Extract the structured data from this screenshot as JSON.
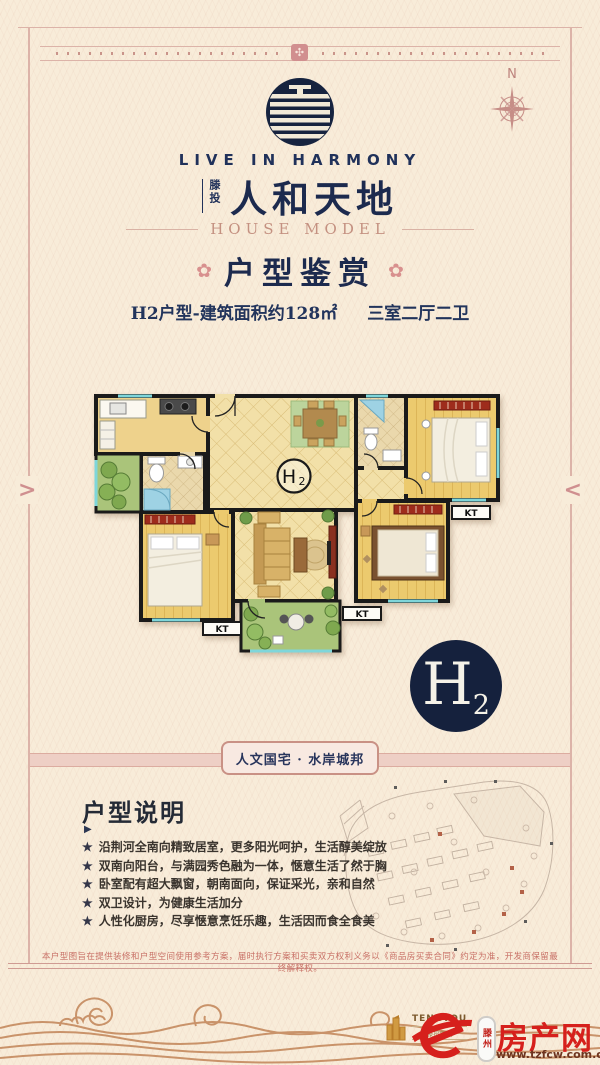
{
  "frame": {
    "chevron_left": ">",
    "chevron_right": "<",
    "rosette": "✣"
  },
  "compass": {
    "label": "N"
  },
  "header": {
    "tagline": "LIVE IN HARMONY",
    "brand_prefix": "滕投",
    "brand": "人和天地",
    "subtitle": "HOUSE MODEL"
  },
  "title": {
    "flower_left": "✿",
    "flower_right": "✿",
    "text": "户型鉴赏"
  },
  "specs": {
    "model": "H2户型-建筑面积约128㎡",
    "rooms": "三室二厅二卫"
  },
  "floorplan": {
    "unit_main": "H",
    "unit_sub": "2",
    "kt": [
      "KT",
      "KT",
      "KT"
    ]
  },
  "badge": {
    "main": "H",
    "sub": "2"
  },
  "banner": {
    "text": "人文国宅 · 水岸城邦"
  },
  "description": {
    "heading": "户型说明",
    "marker": "▶",
    "bullet_icon": "★",
    "bullets": [
      "沿荆河全南向精致居室，更多阳光呵护，生活醇美绽放",
      "双南向阳台，与满园秀色融为一体，惬意生活了然于胸",
      "卧室配有超大飘窗，朝南面向，保证采光，亲和自然",
      "双卫设计，为健康生活加分",
      "人性化厨房，尽享惬意烹饪乐趣，生活因而食全食美"
    ]
  },
  "disclaimer": "本户型图旨在提供装修和户型空间使用参考方案，届时执行方案和买卖双方权利义务以《商品房买卖合同》约定为准，开发商保留最终解释权。",
  "footer": {
    "tengtou_name": "TENGTOU",
    "tengtou_sub": "滕投集团",
    "fcw_city": "滕州",
    "fcw_name": "房产网",
    "fcw_url": "www.tzfcw.com.cn"
  }
}
